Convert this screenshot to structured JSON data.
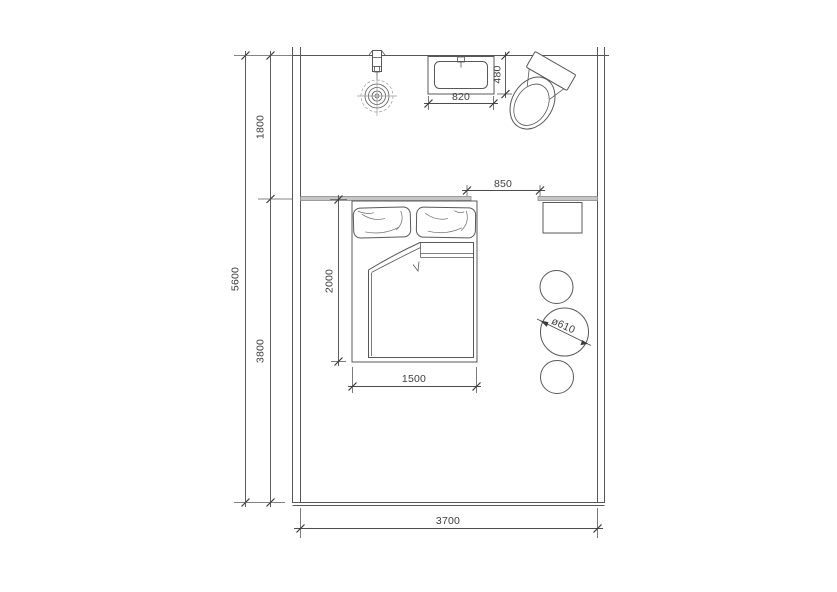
{
  "drawing": {
    "type": "bedroom-floor-plan",
    "labels": {
      "total_height": "5600",
      "zone_top": "1800",
      "zone_bottom": "3800",
      "room_width": "3700",
      "opening_width": "850",
      "basin_width": "820",
      "basin_depth": "480",
      "bed_length": "2000",
      "bed_width": "1500",
      "stool_diameter": "ø610"
    },
    "colors": {
      "line": "#565656",
      "wall_fill": "#c6c6c6",
      "text": "#3d3d3d",
      "background": "#ffffff"
    }
  }
}
